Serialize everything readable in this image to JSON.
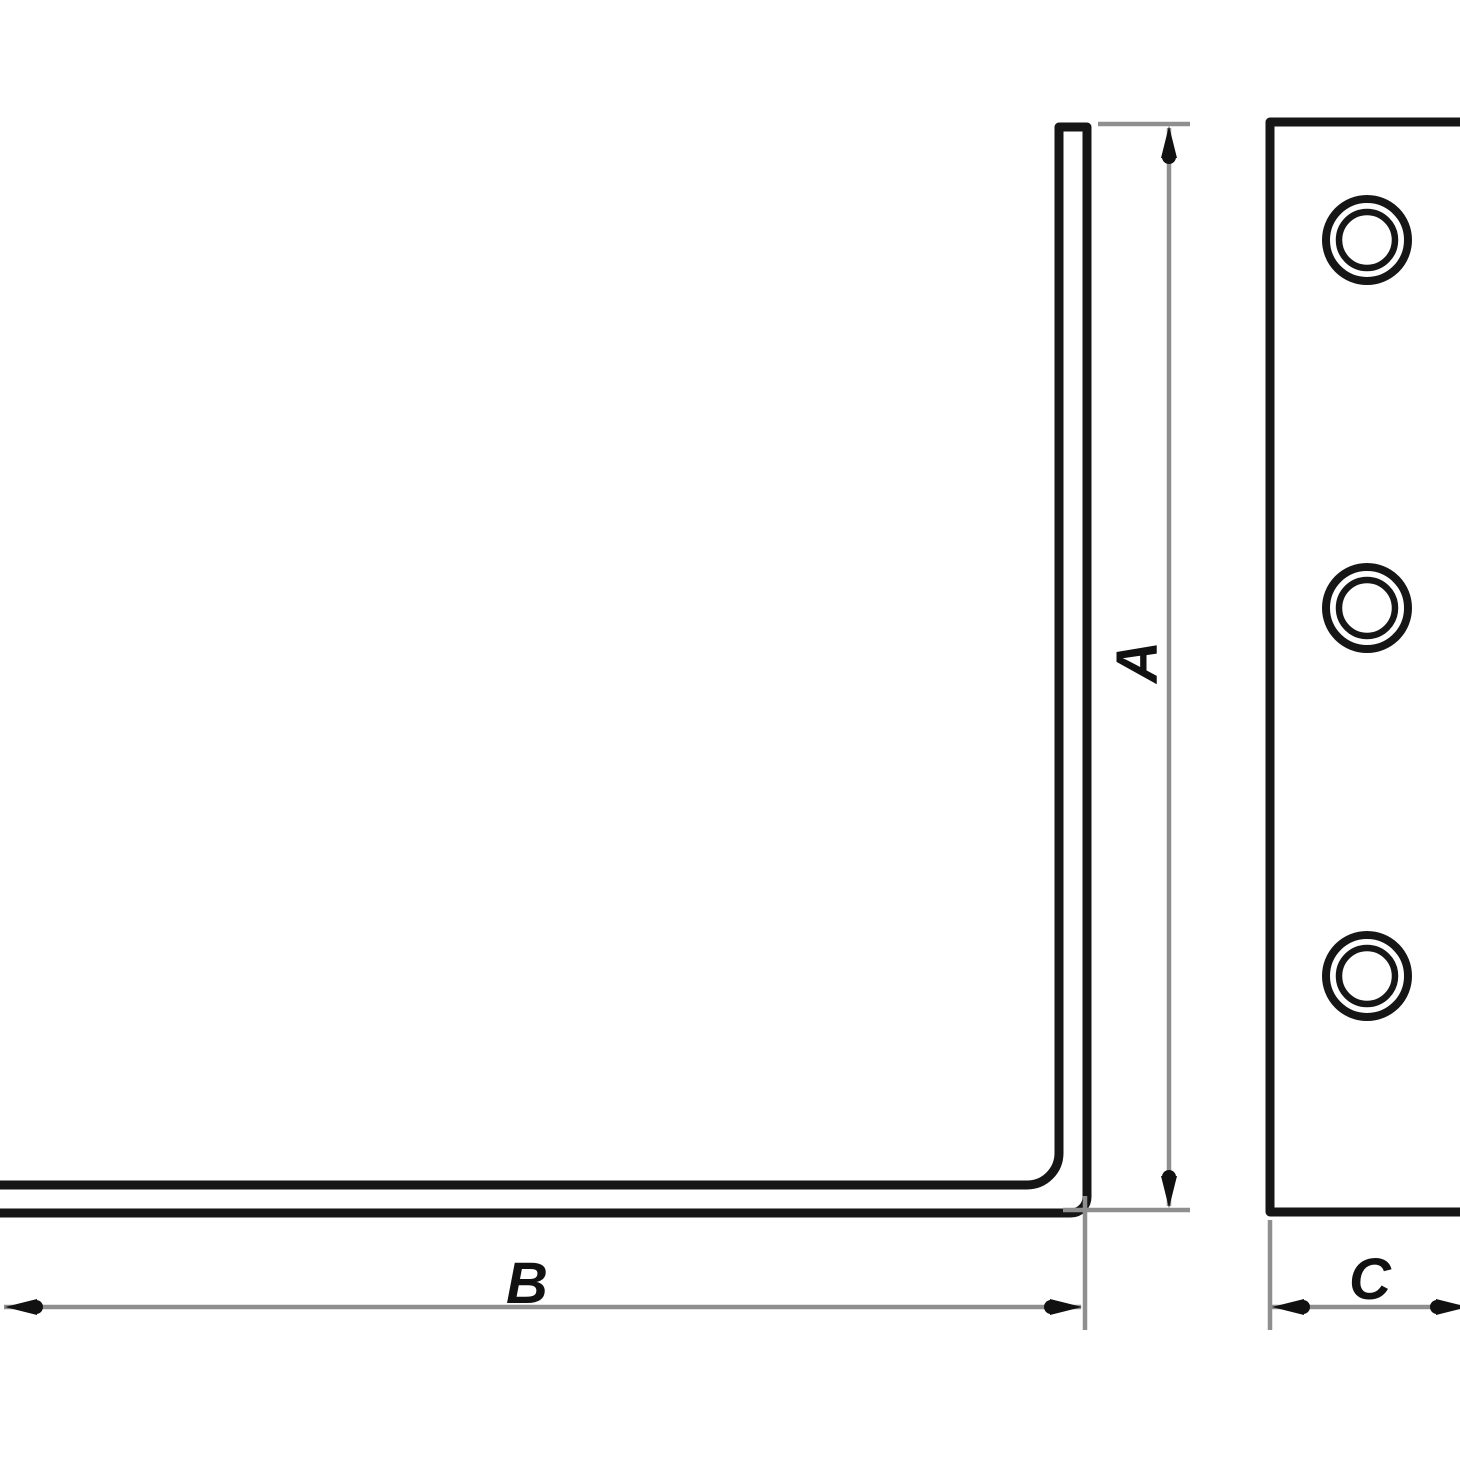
{
  "figure": {
    "kind": "dimensioned-bracket-drawing",
    "colors": {
      "background": "#ffffff",
      "outline": "#161616",
      "dimension_line": "#8f8f8f",
      "arrow": "#111111",
      "label": "#111111"
    },
    "side_view": {
      "shape": "L-profile"
    },
    "face_view": {
      "hole_count": 3
    },
    "dimensions": [
      {
        "id": "A",
        "label": "A",
        "axis": "vertical",
        "measures": "leg height"
      },
      {
        "id": "B",
        "label": "B",
        "axis": "horizontal",
        "measures": "base length"
      },
      {
        "id": "C",
        "label": "C",
        "axis": "horizontal",
        "measures": "plate width"
      }
    ]
  }
}
